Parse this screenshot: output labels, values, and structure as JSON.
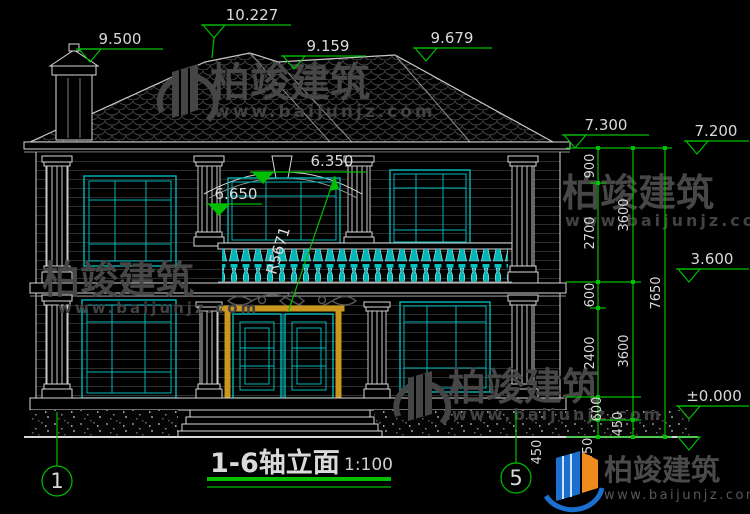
{
  "title_block": {
    "title": "1-6轴立面",
    "scale": "1:100"
  },
  "axis_bubbles": {
    "left": "1",
    "right": "5"
  },
  "watermarks": {
    "brand": "柏竣建筑",
    "site": "www.baijunjz.com"
  },
  "footer_logo": {
    "brand": "柏竣建筑",
    "site": "www.baijunjz.com"
  },
  "elevation_marks": {
    "roof_left": "9.500",
    "roof_peak": "10.227",
    "roof_mid": "9.159",
    "roof_right": "9.679",
    "eave_left": "7.300",
    "eave_right": "7.200",
    "arch_top": "6.350",
    "arch_spring": "6.650",
    "floor2": "3.600",
    "ground": "±0.000"
  },
  "radius_label": "R5671",
  "dim_chains": {
    "inner": [
      "900",
      "2700",
      "600",
      "2400",
      "600",
      "450"
    ],
    "middle": [
      "3600",
      "3600",
      "450"
    ],
    "outer": [
      "7650"
    ],
    "step": "450"
  },
  "colors": {
    "background": "#000000",
    "line_white": "#d8d8d8",
    "cad_green": "#00bf00",
    "cad_cyan": "#00b7b7",
    "door_gold": "#c9971e",
    "watermark_gray": "#474747",
    "logo_blue": "#1b6fd0",
    "logo_orange": "#ef8b1c"
  }
}
